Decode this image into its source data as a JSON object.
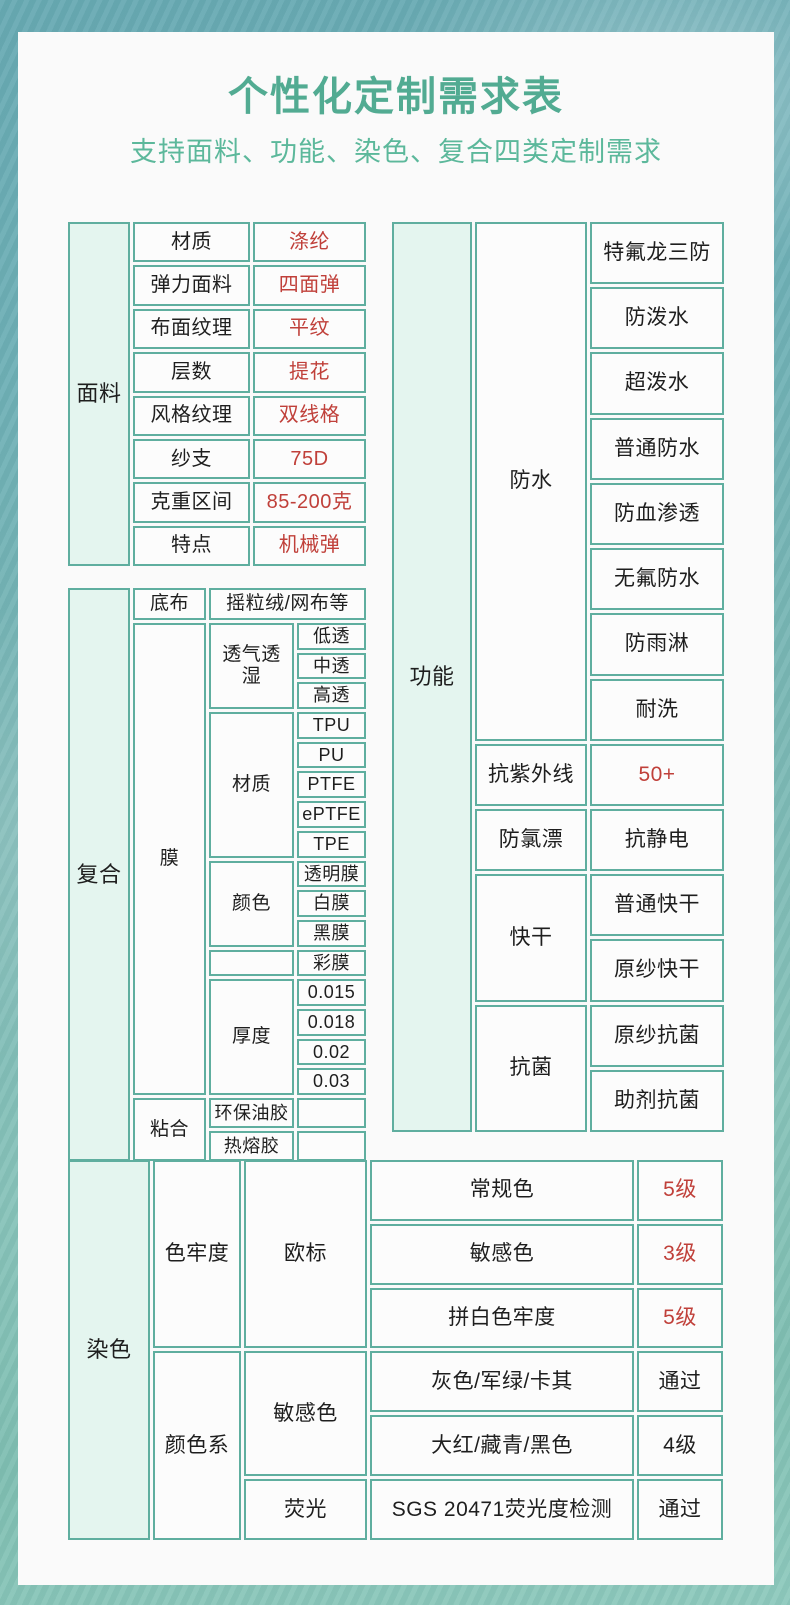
{
  "page": {
    "title": "个性化定制需求表",
    "subtitle": "支持面料、功能、染色、复合四类定制需求"
  },
  "colors": {
    "border_teal": "#5fae9f",
    "category_mint": "#e4f5ef",
    "title_green": "#52ab92",
    "subtitle_green": "#5cb89b",
    "value_red": "#c0403a",
    "card_background": "#fafafa",
    "text_black": "#1e1e1e"
  },
  "fabric_table": {
    "category": "面料",
    "rows": [
      {
        "label": "材质",
        "value": "涤纶"
      },
      {
        "label": "弹力面料",
        "value": "四面弹"
      },
      {
        "label": "布面纹理",
        "value": "平纹"
      },
      {
        "label": "层数",
        "value": "提花"
      },
      {
        "label": "风格纹理",
        "value": "双线格"
      },
      {
        "label": "纱支",
        "value": "75D"
      },
      {
        "label": "克重区间",
        "value": "85-200克"
      },
      {
        "label": "特点",
        "value": "机械弹"
      }
    ]
  },
  "composite_table": {
    "category": "复合",
    "base": {
      "label": "底布",
      "value": "摇粒绒/网布等"
    },
    "membrane_label": "膜",
    "membrane_groups": [
      {
        "label": "透气透湿",
        "options": [
          "低透",
          "中透",
          "高透"
        ]
      },
      {
        "label": "材质",
        "options": [
          "TPU",
          "PU",
          "PTFE",
          "ePTFE",
          "TPE"
        ]
      },
      {
        "label": "颜色",
        "options": [
          "透明膜",
          "白膜",
          "黑膜"
        ]
      },
      {
        "label": "",
        "options": [
          "彩膜"
        ]
      },
      {
        "label": "厚度",
        "options": [
          "0.015",
          "0.018",
          "0.02",
          "0.03"
        ]
      }
    ],
    "bonding": {
      "label": "粘合",
      "options": [
        "环保油胶",
        "热熔胶"
      ]
    }
  },
  "function_table": {
    "category": "功能",
    "sections": [
      {
        "label": "防水",
        "items": [
          {
            "text": "特氟龙三防"
          },
          {
            "text": "防泼水"
          },
          {
            "text": "超泼水"
          },
          {
            "text": "普通防水"
          },
          {
            "text": "防血渗透"
          },
          {
            "text": "无氟防水"
          },
          {
            "text": "防雨淋"
          },
          {
            "text": "耐洗"
          }
        ]
      },
      {
        "label": "抗紫外线",
        "items": [
          {
            "text": "50+",
            "red": true
          }
        ]
      },
      {
        "label": "防氯漂",
        "items": [
          {
            "text": "抗静电"
          }
        ]
      },
      {
        "label": "快干",
        "items": [
          {
            "text": "普通快干"
          },
          {
            "text": "原纱快干"
          }
        ]
      },
      {
        "label": "抗菌",
        "items": [
          {
            "text": "原纱抗菌"
          },
          {
            "text": "助剂抗菌"
          }
        ]
      }
    ]
  },
  "dye_table": {
    "category": "染色",
    "groups": [
      {
        "label": "色牢度",
        "subgroups": [
          {
            "label": "欧标",
            "rows": [
              {
                "item": "常规色",
                "value": "5级",
                "red": true
              },
              {
                "item": "敏感色",
                "value": "3级",
                "red": true
              },
              {
                "item": "拼白色牢度",
                "value": "5级",
                "red": true
              }
            ]
          }
        ]
      },
      {
        "label": "颜色系",
        "subgroups": [
          {
            "label": "敏感色",
            "rows": [
              {
                "item": "灰色/军绿/卡其",
                "value": "通过"
              },
              {
                "item": "大红/藏青/黑色",
                "value": "4级"
              }
            ]
          },
          {
            "label": "荧光",
            "rows": [
              {
                "item": "SGS 20471荧光度检测",
                "value": "通过"
              }
            ]
          }
        ]
      }
    ]
  }
}
